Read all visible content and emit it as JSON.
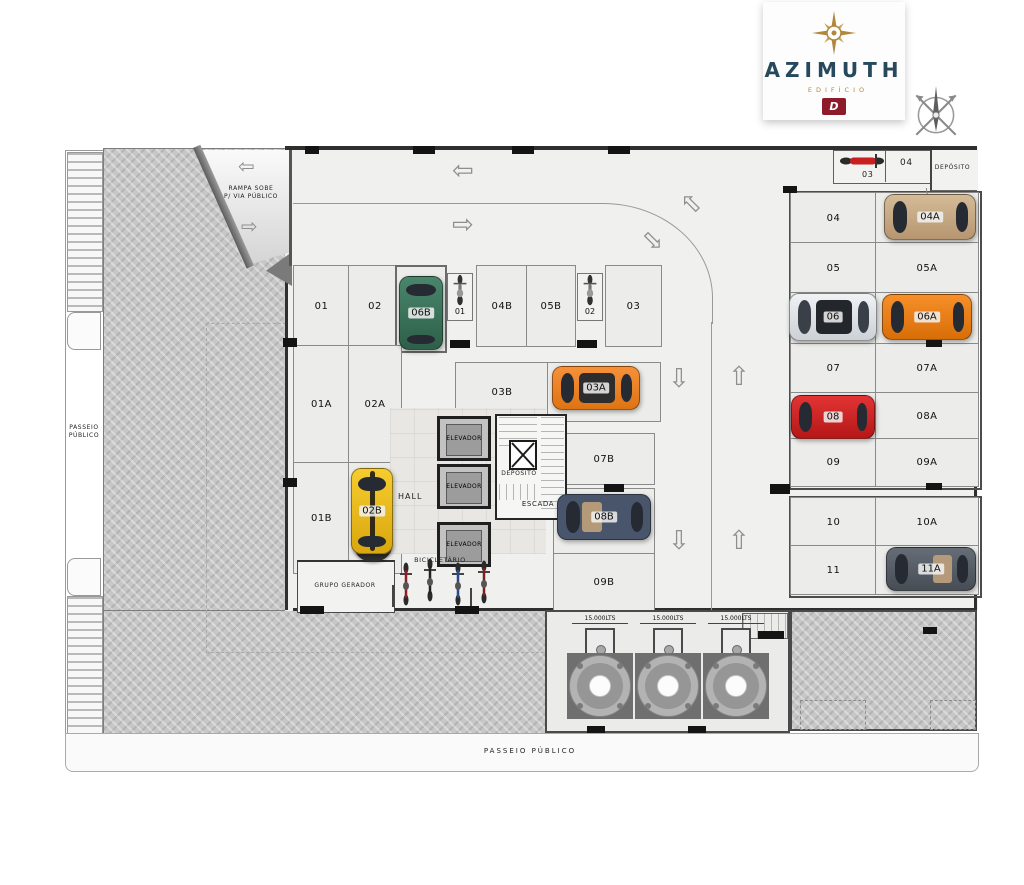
{
  "logo": {
    "title": "AZIMUTH",
    "subtitle": "EDIFÍCIO",
    "emblem": "D"
  },
  "labels": {
    "ramp_line1": "RAMPA  SOBE",
    "ramp_line2": "P/ VIA PÚBLICO",
    "sidewalk_left": "PASSEIO PÚBLICO",
    "sidewalk_bottom": "PASSEIO  PÚBLICO",
    "hall": "HALL",
    "deposito_core": "DEPÓSITO",
    "escada": "ESCADA",
    "bicicletario": "BICICLETÁRIO",
    "grupo_gerador": "GRUPO GERADOR",
    "deposito_top": "DEPÓSITO",
    "elevator": "ELEVADOR",
    "tank": "15.000LTS"
  },
  "spots": {
    "s01": "01",
    "s02": "02",
    "s06B": "06B",
    "m01": "01",
    "s04B": "04B",
    "s05B": "05B",
    "m02": "02",
    "s03": "03",
    "s01A": "01A",
    "s02A": "02A",
    "s01B": "01B",
    "s02B": "02B",
    "s03B": "03B",
    "s03A": "03A",
    "s07B": "07B",
    "s08B": "08B",
    "s09B": "09B",
    "m03": "03",
    "m04": "04",
    "r04": "04",
    "r04A": "04A",
    "r05": "05",
    "r05A": "05A",
    "r06": "06",
    "r06A": "06A",
    "r07": "07",
    "r07A": "07A",
    "r08": "08",
    "r08A": "08A",
    "r09": "09",
    "r09A": "09A",
    "r10": "10",
    "r10A": "10A",
    "r11": "11",
    "r11A": "11A"
  },
  "icons": {
    "arrow_left": "⇦",
    "arrow_right": "⇨",
    "arrow_up": "⇧",
    "arrow_down": "⇩",
    "compass_rose": "compass-rose",
    "compass_star": "gold-compass-star",
    "motorcycle": "motorcycle-top-view",
    "bicycle": "bicycle-top-view"
  },
  "colors": {
    "logo_teal": "#26495e",
    "logo_gold": "#b1873c",
    "emblem_red": "#8d1b2a",
    "floor_grey": "#f0f0ee",
    "hatch_grey": "#c7c7c7",
    "car_green": "#3c7a60",
    "car_yellow": "#f2c21d",
    "car_orange_stripe": "#f08224",
    "car_dark_blue": "#4a5565",
    "car_tan": "#c9ae8c",
    "car_silver": "#e8eaec",
    "car_orange": "#ee8519",
    "car_red": "#d6252b",
    "car_dark_grey": "#596068",
    "moto_red": "#c81f1f"
  }
}
